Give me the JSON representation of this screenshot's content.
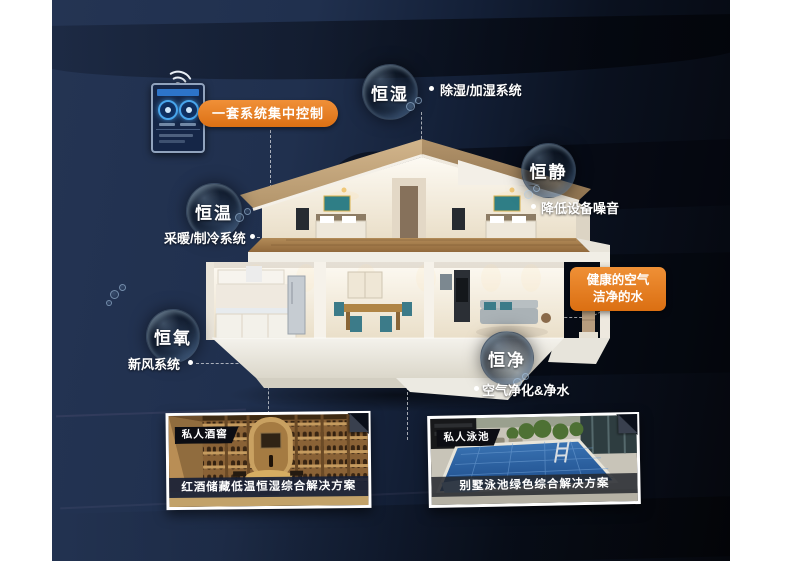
{
  "control": {
    "label": "一套系统集中控制"
  },
  "features": [
    {
      "id": "hengshi",
      "bubble": "恒湿",
      "desc": "除湿/加湿系统"
    },
    {
      "id": "hengjing",
      "bubble": "恒静",
      "desc": "降低设备噪音"
    },
    {
      "id": "hengwen",
      "bubble": "恒温",
      "desc": "采暖/制冷系统"
    },
    {
      "id": "hengyang",
      "bubble": "恒氧",
      "desc": "新风系统"
    },
    {
      "id": "hengjin",
      "bubble": "恒净",
      "desc": "空气净化&净水"
    }
  ],
  "callout": {
    "line1": "健康的空气",
    "line2": "洁净的水"
  },
  "cards": [
    {
      "tag": "私人酒窖",
      "caption": "红酒储藏低温恒湿综合解决方案"
    },
    {
      "tag": "私人泳池",
      "caption": "别墅泳池绿色综合解决方案"
    }
  ],
  "colors": {
    "accent_orange": "#e07a1c",
    "panel_navy": "#20304e",
    "panel_dark": "#05070d"
  },
  "icons": {
    "wifi": "wifi-signal",
    "bubbles": "water-bubble-spheres"
  }
}
